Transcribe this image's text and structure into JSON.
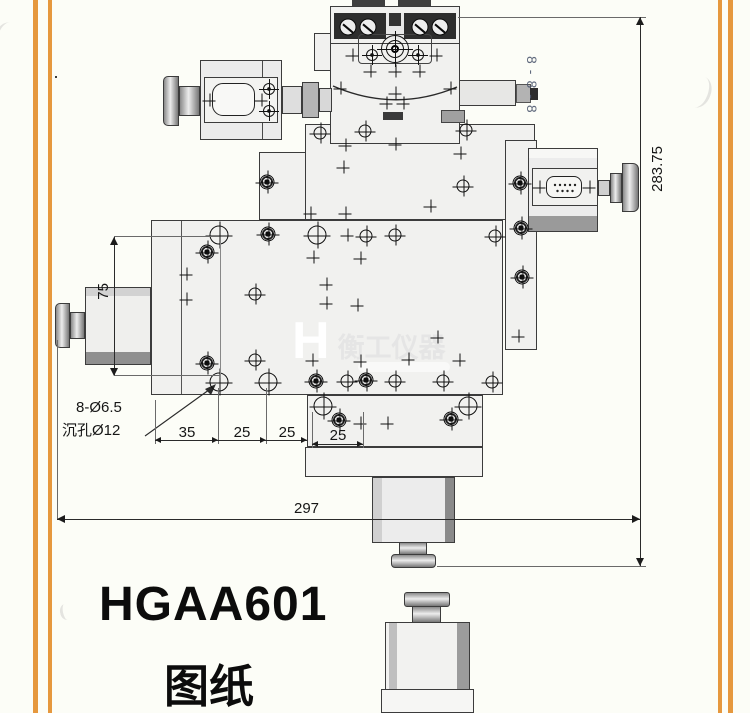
{
  "page": {
    "background": "#fcfdf7",
    "frame_color": "#e6983e"
  },
  "title": {
    "model": "HGAA601",
    "caption": "图纸"
  },
  "dimensions": {
    "total_height": "283.75",
    "total_width": "297",
    "side_height": "75",
    "chain": [
      "35",
      "25",
      "25",
      "25"
    ],
    "hole_note_line1": "8-Ø6.5",
    "hole_note_line2": "沉孔Ø12"
  },
  "watermark": {
    "logo": "H",
    "brand": "衡工仪器",
    "vertical_mark": "8-8-8"
  },
  "drawing": {
    "markers": [
      {
        "x": 348,
        "y": 27,
        "t": "term"
      },
      {
        "x": 368,
        "y": 27,
        "t": "term"
      },
      {
        "x": 420,
        "y": 27,
        "t": "term"
      },
      {
        "x": 440,
        "y": 27,
        "t": "term"
      },
      {
        "x": 395,
        "y": 49,
        "t": "bull"
      },
      {
        "x": 395,
        "y": 49,
        "t": "crossbig"
      },
      {
        "x": 372,
        "y": 55,
        "t": "sr"
      },
      {
        "x": 418,
        "y": 55,
        "t": "sr"
      },
      {
        "x": 269,
        "y": 89,
        "t": "sr"
      },
      {
        "x": 269,
        "y": 111,
        "t": "sr"
      },
      {
        "x": 352,
        "y": 55,
        "t": "cross"
      },
      {
        "x": 436,
        "y": 55,
        "t": "cross"
      },
      {
        "x": 370,
        "y": 71,
        "t": "cross"
      },
      {
        "x": 395,
        "y": 71,
        "t": "cross"
      },
      {
        "x": 419,
        "y": 71,
        "t": "cross"
      },
      {
        "x": 340,
        "y": 88,
        "t": "cross"
      },
      {
        "x": 450,
        "y": 88,
        "t": "cross"
      },
      {
        "x": 395,
        "y": 93,
        "t": "cross"
      },
      {
        "x": 386,
        "y": 103,
        "t": "cross"
      },
      {
        "x": 403,
        "y": 103,
        "t": "cross"
      },
      {
        "x": 209,
        "y": 100,
        "t": "cross"
      },
      {
        "x": 261,
        "y": 100,
        "t": "cross"
      },
      {
        "x": 320,
        "y": 133,
        "t": "cc"
      },
      {
        "x": 365,
        "y": 131,
        "t": "cc"
      },
      {
        "x": 466,
        "y": 130,
        "t": "cc"
      },
      {
        "x": 345,
        "y": 145,
        "t": "cross"
      },
      {
        "x": 395,
        "y": 144,
        "t": "cross"
      },
      {
        "x": 343,
        "y": 167,
        "t": "cross"
      },
      {
        "x": 310,
        "y": 213,
        "t": "cross"
      },
      {
        "x": 345,
        "y": 213,
        "t": "cross"
      },
      {
        "x": 430,
        "y": 206,
        "t": "cross"
      },
      {
        "x": 460,
        "y": 153,
        "t": "cross"
      },
      {
        "x": 463,
        "y": 186,
        "t": "cc"
      },
      {
        "x": 495,
        "y": 236,
        "t": "cc"
      },
      {
        "x": 267,
        "y": 182,
        "t": "screw"
      },
      {
        "x": 520,
        "y": 183,
        "t": "screw"
      },
      {
        "x": 521,
        "y": 228,
        "t": "screw"
      },
      {
        "x": 522,
        "y": 277,
        "t": "screw"
      },
      {
        "x": 518,
        "y": 336,
        "t": "cross"
      },
      {
        "x": 539,
        "y": 187,
        "t": "cross"
      },
      {
        "x": 589,
        "y": 187,
        "t": "cross"
      },
      {
        "x": 219,
        "y": 235,
        "t": "ccb"
      },
      {
        "x": 268,
        "y": 234,
        "t": "screw"
      },
      {
        "x": 317,
        "y": 235,
        "t": "ccb"
      },
      {
        "x": 347,
        "y": 235,
        "t": "cross"
      },
      {
        "x": 366,
        "y": 236,
        "t": "cc"
      },
      {
        "x": 395,
        "y": 235,
        "t": "cc"
      },
      {
        "x": 207,
        "y": 252,
        "t": "screw"
      },
      {
        "x": 186,
        "y": 274,
        "t": "cross"
      },
      {
        "x": 186,
        "y": 299,
        "t": "cross"
      },
      {
        "x": 255,
        "y": 294,
        "t": "cc"
      },
      {
        "x": 313,
        "y": 257,
        "t": "cross"
      },
      {
        "x": 360,
        "y": 258,
        "t": "cross"
      },
      {
        "x": 326,
        "y": 284,
        "t": "cross"
      },
      {
        "x": 326,
        "y": 303,
        "t": "cross"
      },
      {
        "x": 357,
        "y": 305,
        "t": "cross"
      },
      {
        "x": 437,
        "y": 337,
        "t": "cross"
      },
      {
        "x": 459,
        "y": 360,
        "t": "cross"
      },
      {
        "x": 207,
        "y": 363,
        "t": "screw"
      },
      {
        "x": 255,
        "y": 360,
        "t": "cc"
      },
      {
        "x": 312,
        "y": 360,
        "t": "cross"
      },
      {
        "x": 360,
        "y": 361,
        "t": "cross"
      },
      {
        "x": 408,
        "y": 359,
        "t": "cross"
      },
      {
        "x": 219,
        "y": 382,
        "t": "ccb"
      },
      {
        "x": 268,
        "y": 382,
        "t": "ccb"
      },
      {
        "x": 316,
        "y": 381,
        "t": "screw"
      },
      {
        "x": 347,
        "y": 381,
        "t": "cc"
      },
      {
        "x": 366,
        "y": 380,
        "t": "screw"
      },
      {
        "x": 395,
        "y": 381,
        "t": "cc"
      },
      {
        "x": 443,
        "y": 381,
        "t": "cc"
      },
      {
        "x": 492,
        "y": 382,
        "t": "cc"
      },
      {
        "x": 323,
        "y": 406,
        "t": "ccb"
      },
      {
        "x": 339,
        "y": 420,
        "t": "screw"
      },
      {
        "x": 360,
        "y": 423,
        "t": "cross"
      },
      {
        "x": 387,
        "y": 423,
        "t": "cross"
      },
      {
        "x": 451,
        "y": 419,
        "t": "screw"
      },
      {
        "x": 468,
        "y": 406,
        "t": "ccb"
      }
    ]
  }
}
